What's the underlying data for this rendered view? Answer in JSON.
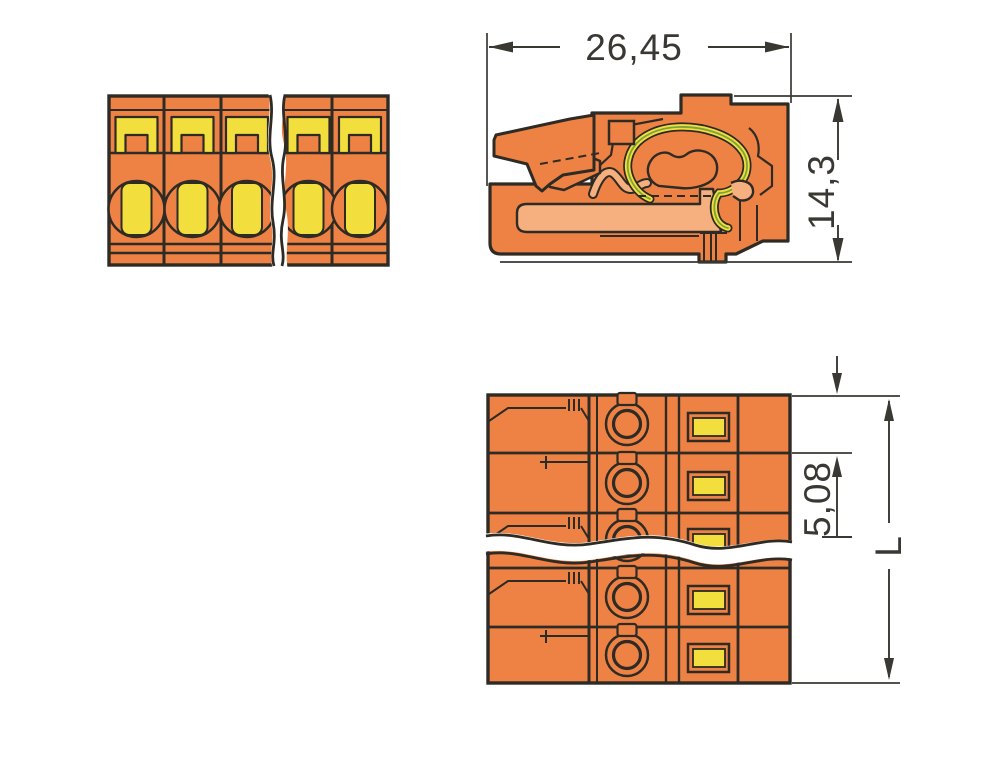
{
  "drawing": {
    "kind": "dimensioned 3-view engineering drawing",
    "subject": "orange multi-pole pluggable terminal block connector shown with break lines",
    "poles_visible_front_view": 5,
    "poles_visible_top_view": 5
  },
  "dimensions": {
    "depth_label": "26,45",
    "height_label": "14,3",
    "pitch_label": "5,08",
    "length_label": "L"
  },
  "colors": {
    "housing_orange": "#EE8245",
    "recess_peach": "#F6AF7E",
    "detail_yellow": "#F2DE3C",
    "spring_green": "#7CA33C",
    "outline_dark": "#2E2A24",
    "dimension_gray": "#3A3833",
    "background": "#FFFFFF"
  }
}
